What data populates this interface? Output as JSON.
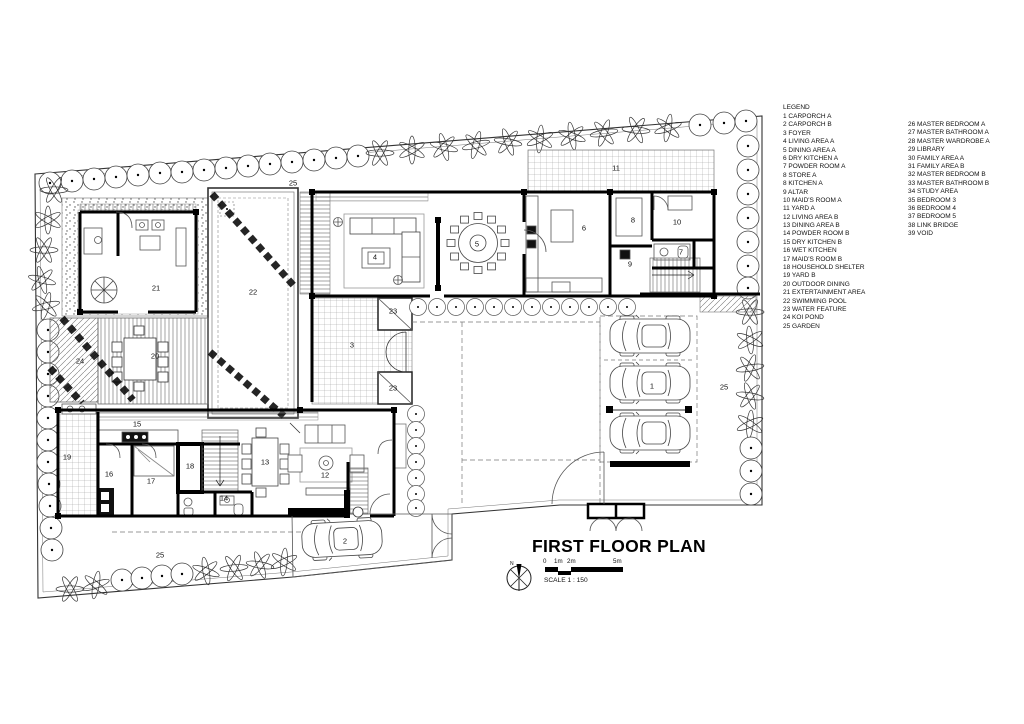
{
  "colors": {
    "background": "#ffffff",
    "line": "#000000"
  },
  "plan": {
    "title": "FIRST FLOOR PLAN",
    "scale_label": "SCALE 1 : 150",
    "scale_ticks": [
      "0",
      "1m",
      "2m",
      "5m"
    ],
    "north_label": "N",
    "room_labels": [
      {
        "num": "1",
        "x": 652,
        "y": 386
      },
      {
        "num": "2",
        "x": 345,
        "y": 541
      },
      {
        "num": "3",
        "x": 352,
        "y": 345
      },
      {
        "num": "4",
        "x": 375,
        "y": 257
      },
      {
        "num": "5",
        "x": 477,
        "y": 244
      },
      {
        "num": "6",
        "x": 584,
        "y": 228
      },
      {
        "num": "7",
        "x": 681,
        "y": 252
      },
      {
        "num": "8",
        "x": 633,
        "y": 220
      },
      {
        "num": "9",
        "x": 630,
        "y": 264
      },
      {
        "num": "10",
        "x": 677,
        "y": 222
      },
      {
        "num": "11",
        "x": 616,
        "y": 168
      },
      {
        "num": "12",
        "x": 325,
        "y": 475
      },
      {
        "num": "13",
        "x": 265,
        "y": 462
      },
      {
        "num": "14",
        "x": 224,
        "y": 498
      },
      {
        "num": "15",
        "x": 137,
        "y": 424
      },
      {
        "num": "16",
        "x": 109,
        "y": 474
      },
      {
        "num": "17",
        "x": 151,
        "y": 481
      },
      {
        "num": "18",
        "x": 190,
        "y": 466
      },
      {
        "num": "19",
        "x": 67,
        "y": 457
      },
      {
        "num": "20",
        "x": 155,
        "y": 356
      },
      {
        "num": "21",
        "x": 156,
        "y": 288
      },
      {
        "num": "22",
        "x": 253,
        "y": 292
      },
      {
        "num": "23",
        "x": 393,
        "y": 311
      },
      {
        "num": "23",
        "x": 393,
        "y": 388
      },
      {
        "num": "24",
        "x": 80,
        "y": 361
      },
      {
        "num": "25",
        "x": 293,
        "y": 183
      },
      {
        "num": "25",
        "x": 724,
        "y": 387
      },
      {
        "num": "25",
        "x": 160,
        "y": 555
      }
    ]
  },
  "legend": {
    "heading": "LEGEND",
    "col1": [
      {
        "num": "1",
        "label": "CARPORCH A"
      },
      {
        "num": "2",
        "label": "CARPORCH B"
      },
      {
        "num": "3",
        "label": "FOYER"
      },
      {
        "num": "4",
        "label": "LIVING AREA A"
      },
      {
        "num": "5",
        "label": "DINING AREA A"
      },
      {
        "num": "6",
        "label": "DRY KITCHEN A"
      },
      {
        "num": "7",
        "label": "POWDER ROOM A"
      },
      {
        "num": "8",
        "label": "STORE A"
      },
      {
        "num": "8",
        "label": "KITCHEN A"
      },
      {
        "num": "9",
        "label": "ALTAR"
      },
      {
        "num": "10",
        "label": "MAID'S ROOM A"
      },
      {
        "num": "11",
        "label": "YARD A"
      },
      {
        "num": "12",
        "label": "LIVING AREA B"
      },
      {
        "num": "13",
        "label": "DINING AREA B"
      },
      {
        "num": "14",
        "label": "POWDER ROOM B"
      },
      {
        "num": "15",
        "label": "DRY KITCHEN B"
      },
      {
        "num": "16",
        "label": "WET KITCHEN"
      },
      {
        "num": "17",
        "label": "MAID'S ROOM B"
      },
      {
        "num": "18",
        "label": "HOUSEHOLD SHELTER"
      },
      {
        "num": "19",
        "label": "YARD B"
      },
      {
        "num": "20",
        "label": "OUTDOOR DINING"
      },
      {
        "num": "21",
        "label": "EXTERTAINMENT AREA"
      },
      {
        "num": "22",
        "label": "SWIMMING POOL"
      },
      {
        "num": "23",
        "label": "WATER FEATURE"
      },
      {
        "num": "24",
        "label": "KOI POND"
      },
      {
        "num": "25",
        "label": "GARDEN"
      }
    ],
    "col2": [
      {
        "num": "26",
        "label": "MASTER BEDROOM A"
      },
      {
        "num": "27",
        "label": "MASTER BATHROOM A"
      },
      {
        "num": "28",
        "label": "MASTER WARDROBE A"
      },
      {
        "num": "29",
        "label": "LIBRARY"
      },
      {
        "num": "30",
        "label": "FAMILY AREA A"
      },
      {
        "num": "31",
        "label": "FAMILY AREA B"
      },
      {
        "num": "32",
        "label": "MASTER BEDROOM B"
      },
      {
        "num": "33",
        "label": "MASTER BATHROOM B"
      },
      {
        "num": "34",
        "label": "STUDY AREA"
      },
      {
        "num": "35",
        "label": "BEDROOM 3"
      },
      {
        "num": "36",
        "label": "BEDROOM 4"
      },
      {
        "num": "37",
        "label": "BEDROOM 5"
      },
      {
        "num": "38",
        "label": "LINK BRIDGE"
      },
      {
        "num": "39",
        "label": "VOID"
      }
    ]
  }
}
